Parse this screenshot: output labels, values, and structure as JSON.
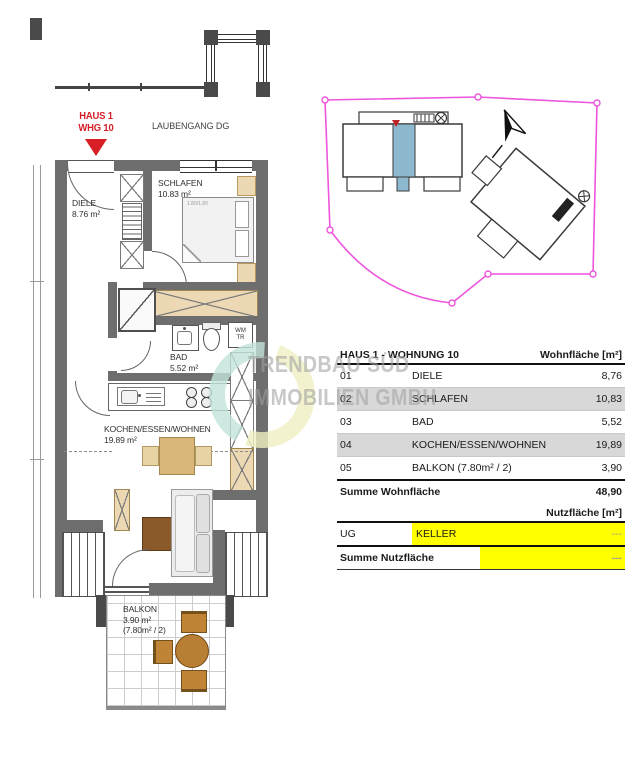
{
  "plan": {
    "unit_marker": {
      "line1": "HAUS 1",
      "line2": "WHG 10"
    },
    "corridor_label": "LAUBENGANG DG",
    "rooms": {
      "diele": {
        "name": "DIELE",
        "area": "8.76 m²"
      },
      "schlafen": {
        "name": "SCHLAFEN",
        "area": "10.83 m²"
      },
      "bad": {
        "name": "BAD",
        "area": "5.52 m²"
      },
      "wohnen": {
        "name": "KOCHEN/ESSEN/WOHNEN",
        "area": "19.89 m²"
      },
      "balkon": {
        "name": "BALKON",
        "area": "3.90 m²",
        "note": "(7.80m² / 2)"
      }
    },
    "bed_label": "1.80/1.80",
    "closet": {
      "line1": "WM",
      "line2": "TR"
    }
  },
  "watermark": {
    "line1": "TRENDBAU SÜD",
    "line2": "IMMOBILIEN GMBH"
  },
  "area_table": {
    "title": "HAUS 1 - WOHNUNG 10",
    "unit_header": "Wohnfläche [m²]",
    "rows": [
      {
        "no": "01",
        "name": "DIELE",
        "value": "8,76"
      },
      {
        "no": "02",
        "name": "SCHLAFEN",
        "value": "10,83"
      },
      {
        "no": "03",
        "name": "BAD",
        "value": "5,52"
      },
      {
        "no": "04",
        "name": "KOCHEN/ESSEN/WOHNEN",
        "value": "19,89"
      },
      {
        "no": "05",
        "name": "BALKON (7.80m² / 2)",
        "value": "3,90"
      }
    ],
    "total_label": "Summe Wohnfläche",
    "total_value": "48,90"
  },
  "utility_table": {
    "unit_header": "Nutzfläche [m²]",
    "row": {
      "no": "UG",
      "name": "KELLER",
      "value": "---"
    },
    "total_label": "Summe Nutzfläche",
    "total_value": "---"
  },
  "colors": {
    "boundary_magenta": "#ee55dd",
    "highlight_yellow": "#ffff00",
    "marker_red": "#d81f26",
    "siteplan_blue": "#8db9cf",
    "shaded_row_gray": "#d8d8d8",
    "watermark_gray": "#c6c6c6",
    "furniture_beige": "#ecd9b4",
    "wood_brown": "#8a5a2a"
  }
}
